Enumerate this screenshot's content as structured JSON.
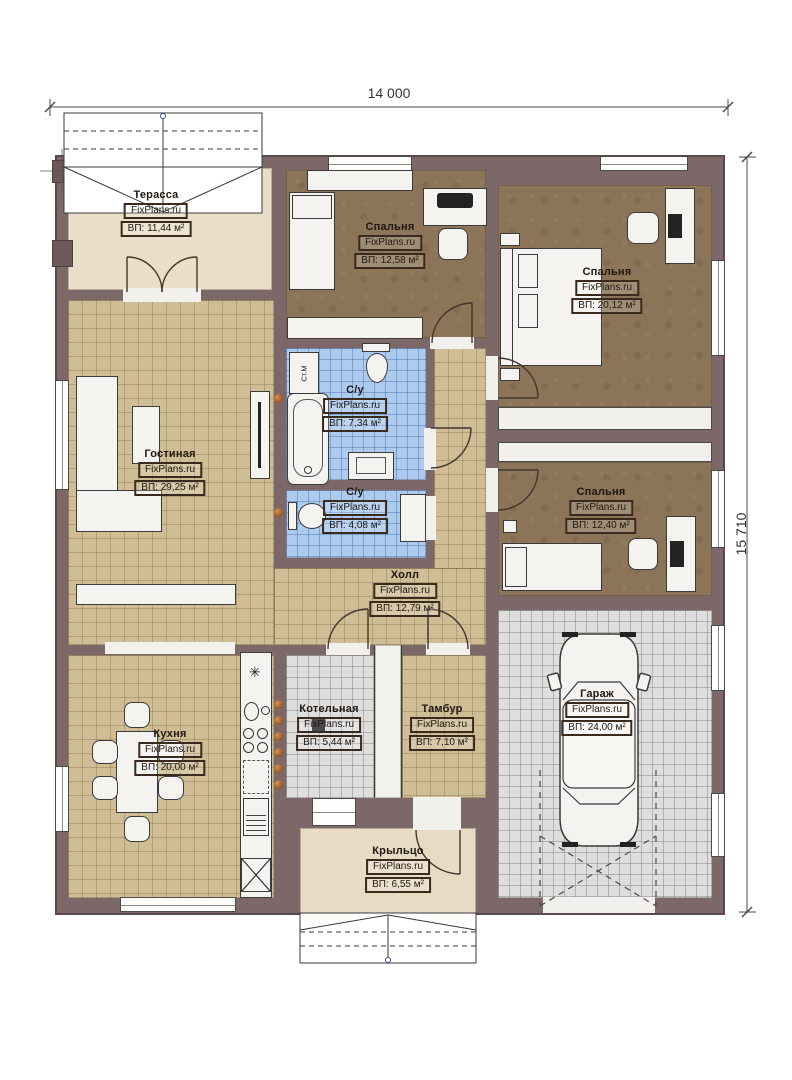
{
  "meta": {
    "plan_width_label": "14 000",
    "plan_height_label": "15 710"
  },
  "brand": "FixPlans.ru",
  "rooms": [
    {
      "id": "terrace",
      "name": "Терасса",
      "area": "ВП: 11,44 м²"
    },
    {
      "id": "bedroom-top",
      "name": "Спальня",
      "area": "ВП: 12,58 м²"
    },
    {
      "id": "bedroom-right",
      "name": "Спальня",
      "area": "ВП: 20,12 м²"
    },
    {
      "id": "bathroom-big",
      "name": "С/у",
      "area": "ВП: 7,34 м²"
    },
    {
      "id": "living-room",
      "name": "Гостиная",
      "area": "ВП: 29,25 м²"
    },
    {
      "id": "bathroom-small",
      "name": "С/у",
      "area": "ВП: 4,08 м²"
    },
    {
      "id": "bedroom-mid",
      "name": "Спальня",
      "area": "ВП: 12,40 м²"
    },
    {
      "id": "hall",
      "name": "Холл",
      "area": "ВП: 12,79 м²"
    },
    {
      "id": "kitchen",
      "name": "Кухня",
      "area": "ВП: 20,00 м²"
    },
    {
      "id": "boiler-room",
      "name": "Котельная",
      "area": "ВП: 5,44 м²"
    },
    {
      "id": "vestibule",
      "name": "Тамбур",
      "area": "ВП: 7,10 м²"
    },
    {
      "id": "garage",
      "name": "Гараж",
      "area": "ВП: 24,00 м²"
    },
    {
      "id": "porch",
      "name": "Крыльцо",
      "area": "ВП: 6,55 м²"
    }
  ],
  "labels": {
    "washing_machine": "Ст.М"
  },
  "colors": {
    "wall": "#7c6769",
    "floor_wood": "#cfbd96",
    "floor_bedroom": "#8b7457",
    "floor_bath": "#adcbee",
    "floor_utility": "#dedede",
    "floor_terrace": "#e9dec8",
    "floor_porch": "#e7dbc4",
    "accent_vent": "#d9914f"
  }
}
